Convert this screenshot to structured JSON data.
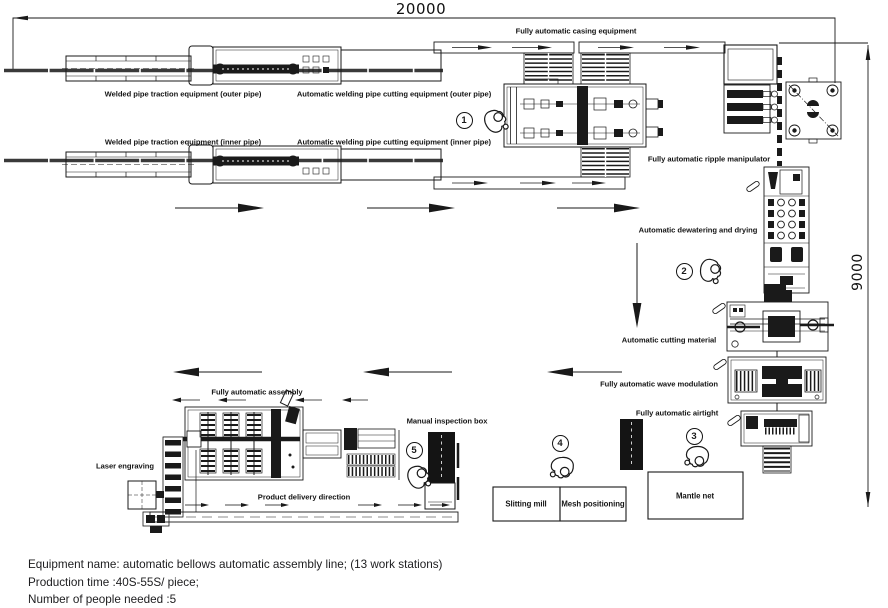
{
  "diagram": {
    "dim_width": "20000",
    "dim_height": "9000"
  },
  "labels": {
    "casing": "Fully automatic casing equipment",
    "traction_outer": "Welded pipe traction equipment (outer pipe)",
    "cutting_outer": "Automatic welding pipe cutting equipment (outer pipe)",
    "traction_inner": "Welded pipe traction equipment (inner pipe)",
    "cutting_inner": "Automatic welding pipe cutting equipment (inner pipe)",
    "ripple": "Fully automatic ripple manipulator",
    "dewatering": "Automatic dewatering and drying",
    "cutting_material": "Automatic cutting material",
    "wave_modulation": "Fully automatic wave modulation",
    "airtight": "Fully automatic airtight",
    "mantle_net": "Mantle net",
    "slitting_mill": "Slitting mill",
    "mesh_positioning": "Mesh positioning",
    "assembly": "Fully automatic assembly",
    "manual_inspection": "Manual inspection box",
    "laser_engraving": "Laser engraving",
    "delivery_direction": "Product delivery direction"
  },
  "stations": [
    "1",
    "2",
    "3",
    "4",
    "5"
  ],
  "notes": [
    "Equipment name: automatic bellows automatic assembly line; (13 work stations)",
    "Production time :40S-55S/ piece;",
    "Number of people needed :5"
  ]
}
